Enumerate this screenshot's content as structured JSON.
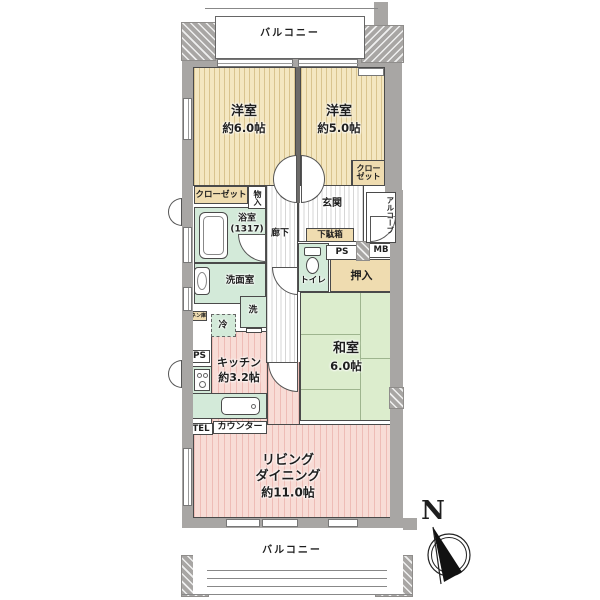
{
  "colors": {
    "wall": "#a8a6a4",
    "bedroom_floor": "#f4e7c1",
    "bedroom_stripe": "#d9c48f",
    "ldk_floor": "#f8dcd6",
    "ldk_stripe": "#eebcb6",
    "wet_room": "#d3ead9",
    "tatami": "#dcedcd",
    "storage": "#efdcb0"
  },
  "balcony_top": {
    "label": "バルコニー"
  },
  "balcony_bottom": {
    "label": "バルコニー"
  },
  "rooms": {
    "western6": {
      "name": "洋室",
      "size": "約6.0帖"
    },
    "western5": {
      "name": "洋室",
      "size": "約5.0帖"
    },
    "japanese": {
      "name": "和室",
      "size": "6.0帖"
    },
    "living": {
      "line1": "リビング",
      "line2": "ダイニング",
      "line3": "約11.0帖"
    },
    "kitchen": {
      "name": "キッチン",
      "size": "約3.2帖"
    },
    "bath": {
      "name": "浴室",
      "size": "(1317)"
    },
    "washroom": {
      "name": "洗面室"
    },
    "toilet": {
      "name": "トイレ"
    },
    "entrance": {
      "name": "玄関"
    },
    "corridor": {
      "name": "廊下"
    },
    "alcove": {
      "name": "アルコーブ"
    }
  },
  "storage": {
    "closet_west": "クローゼット",
    "closet_ne_l1": "クロー",
    "closet_ne_l2": "ゼット",
    "mono_ire": "物入",
    "oshiire": "押入",
    "getabako": "下駄箱",
    "linen": "リネン庫"
  },
  "labels": {
    "washer": "洗",
    "fridge": "冷",
    "counter": "カウンター",
    "tel": "TEL",
    "ps_right": "PS",
    "ps_left": "PS",
    "mb": "MB"
  },
  "compass": {
    "north": "N"
  }
}
